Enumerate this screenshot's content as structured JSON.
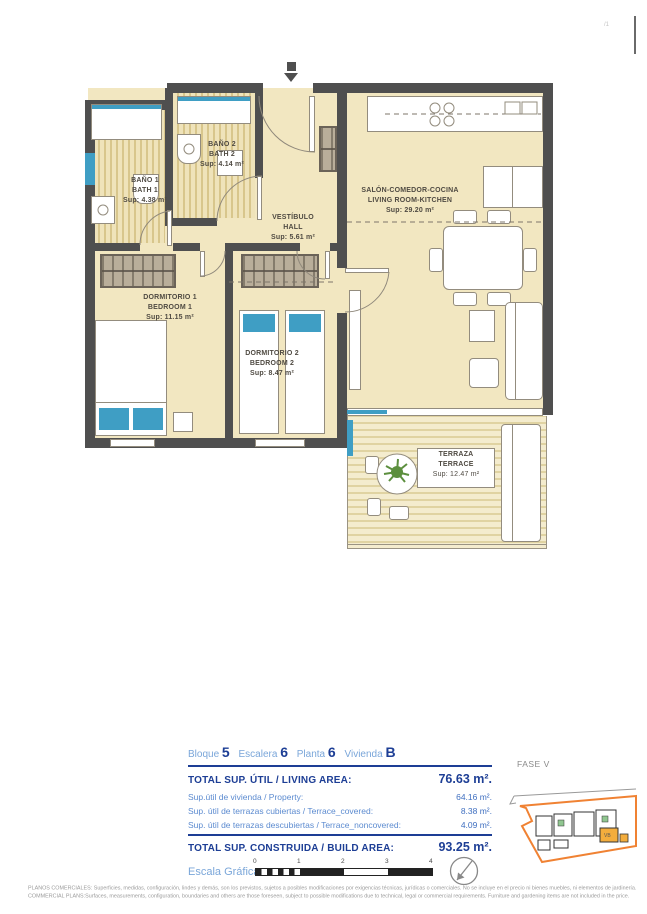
{
  "page": {
    "corner_mark": "/1"
  },
  "plan": {
    "rooms": [
      {
        "id": "bath1",
        "name_es": "BAÑO 1",
        "name_en": "BATH 1",
        "area": "Sup: 4.38 m²"
      },
      {
        "id": "bath2",
        "name_es": "BAÑO 2",
        "name_en": "BATH 2",
        "area": "Sup: 4.14 m²"
      },
      {
        "id": "hall",
        "name_es": "VESTÍBULO",
        "name_en": "HALL",
        "area": "Sup: 5.61 m²"
      },
      {
        "id": "living",
        "name_es": "SALÓN-COMEDOR-COCINA",
        "name_en": "LIVING ROOM-KITCHEN",
        "area": "Sup: 29.20 m²"
      },
      {
        "id": "bedroom1",
        "name_es": "DORMITORIO 1",
        "name_en": "BEDROOM 1",
        "area": "Sup: 11.15 m²"
      },
      {
        "id": "bedroom2",
        "name_es": "DORMITORIO 2",
        "name_en": "BEDROOM 2",
        "area": "Sup: 8.47 m²"
      },
      {
        "id": "terrace",
        "name_es": "TERRAZA",
        "name_en": "TERRACE",
        "area": "Sup: 12.47 m²"
      }
    ]
  },
  "info": {
    "unit": {
      "items": [
        {
          "label": "Bloque",
          "value": "5"
        },
        {
          "label": "Escalera",
          "value": "6"
        },
        {
          "label": "Planta",
          "value": "6"
        },
        {
          "label": "Vivienda",
          "value": "B"
        }
      ]
    },
    "total_util": {
      "label": "TOTAL SUP. ÚTIL / LIVING AREA:",
      "value": "76.63 m²."
    },
    "breakdown": [
      {
        "label": "Sup.útil de vivienda / Property:",
        "value": "64.16 m²."
      },
      {
        "label": "Sup. útil de terrazas cubiertas  / Terrace_covered:",
        "value": "8.38 m²."
      },
      {
        "label": "Sup. útil de terrazas descubiertas  / Terrace_noncovered:",
        "value": "4.09 m²."
      }
    ],
    "total_built": {
      "label": "TOTAL SUP. CONSTRUIDA / BUILD AREA:",
      "value": "93.25 m²."
    },
    "scale": {
      "label": "Escala Gráfica",
      "ticks": [
        "0",
        "1",
        "2",
        "3",
        "4"
      ]
    },
    "phase": "FASE V"
  },
  "minimap": {
    "unit_label": "VB"
  },
  "footer": {
    "line1": "PLANOS COMERCIALES: Superficies, medidas, configuración, lindes y demás, son los previstos, sujetos a posibles modificaciones por exigencias técnicas, jurídicas o comerciales. No se incluye en el precio ni bienes muebles, ni elementos de jardinería.",
    "line2": "COMMERCIAL PLANS:Surfaces, measurements, configuration, boundaries and others are those foreseen, subject to possible modifications due to technical, legal or commercial requirements. Furniture and gardening items are not included in the price."
  },
  "colors": {
    "wall": "#4f4f4f",
    "floor_cream": "#f2e7c1",
    "accent_blue": "#3f9ec4",
    "navy": "#1d3e95",
    "light_blue": "#7aa6d9",
    "orange": "#f08233",
    "green": "#90c690",
    "gray_text": "#9b9b9b"
  }
}
